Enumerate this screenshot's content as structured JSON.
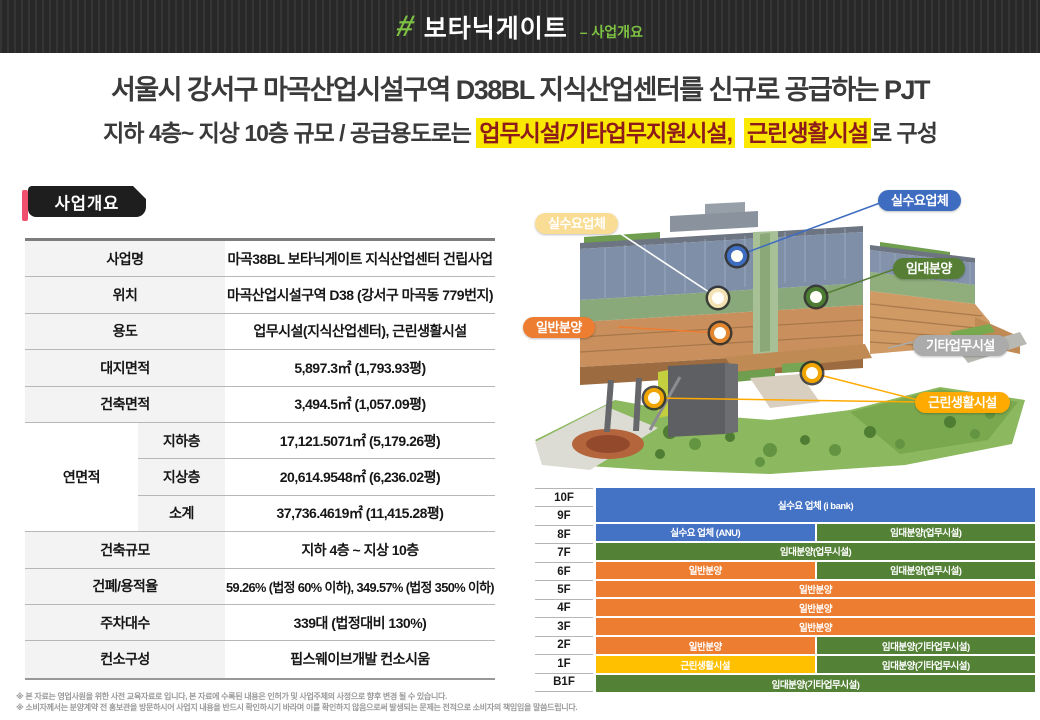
{
  "header": {
    "hash": "#",
    "brand": "보타닉게이트",
    "section": "– 사업개요"
  },
  "title": "서울시 강서구 마곡산업시설구역 D38BL 지식산업센터를 신규로 공급하는 PJT",
  "subtitle": {
    "part1": "지하 4층~ 지상 10층 규모 / 공급용도로는 ",
    "highlight1": "업무시설/기타업무지원시설,",
    "highlight2": "근린생활시설",
    "part2": "로 구성"
  },
  "overview": {
    "tab_label": "사업개요",
    "rows_top": [
      {
        "label": "사업명",
        "value": "마곡38BL 보타닉게이트 지식산업센터 건립사업"
      },
      {
        "label": "위치",
        "value": "마곡산업시설구역 D38 (강서구 마곡동 779번지)"
      },
      {
        "label": "용도",
        "value": "업무시설(지식산업센터), 근린생활시설"
      },
      {
        "label": "대지면적",
        "value": "5,897.3㎡ (1,793.93평)"
      },
      {
        "label": "건축면적",
        "value": "3,494.5㎡ (1,057.09평)"
      }
    ],
    "area": {
      "label": "연면적",
      "sub_rows": [
        {
          "label": "지하층",
          "value": "17,121.5071㎡ (5,179.26평)"
        },
        {
          "label": "지상층",
          "value": "20,614.9548㎡ (6,236.02평)"
        },
        {
          "label": "소계",
          "value": "37,736.4619㎡ (11,415.28평)"
        }
      ]
    },
    "rows_bottom": [
      {
        "label": "건축규모",
        "value": "지하 4층 ~ 지상 10층"
      },
      {
        "label": "건폐/용적율",
        "value": "59.26% (법정 60% 이하), 349.57% (법정 350% 이하)"
      },
      {
        "label": "주차대수",
        "value": "339대 (법정대비 130%)"
      },
      {
        "label": "컨소구성",
        "value": "핍스웨이브개발 컨소시움"
      }
    ]
  },
  "building": {
    "callouts": [
      {
        "id": "demand-top",
        "label": "실수요업체",
        "color": "#3e6cc0"
      },
      {
        "id": "demand-left",
        "label": "실수요업체",
        "color": "#f9dd94"
      },
      {
        "id": "lease",
        "label": "임대분양",
        "color": "#567f35"
      },
      {
        "id": "general",
        "label": "일반분양",
        "color": "#ed7d31"
      },
      {
        "id": "other-biz",
        "label": "기타업무시설",
        "color": "#ababab"
      },
      {
        "id": "neighborhood",
        "label": "근린생활시설",
        "color": "#ffaa00"
      }
    ]
  },
  "floor_chart": {
    "type": "table",
    "floor_labels": [
      "10F",
      "9F",
      "8F",
      "7F",
      "6F",
      "5F",
      "4F",
      "3F",
      "2F",
      "1F",
      "B1F"
    ],
    "legend_colors": {
      "demand": "#4472c4",
      "lease": "#538135",
      "general": "#ed7d31",
      "neighborhood": "#ffc000"
    },
    "rows": [
      {
        "floors": "10F-9F",
        "segments": [
          {
            "type": "demand",
            "label": "실수요 업체 (i bank)",
            "width": 100
          }
        ]
      },
      {
        "floors": "8F",
        "segments": [
          {
            "type": "demand",
            "label": "실수요 업체 (ANU)",
            "width": 50
          },
          {
            "type": "lease",
            "label": "임대분양(업무시설)",
            "width": 50
          }
        ]
      },
      {
        "floors": "7F",
        "segments": [
          {
            "type": "lease",
            "label": "임대분양(업무시설)",
            "width": 100
          }
        ]
      },
      {
        "floors": "6F",
        "segments": [
          {
            "type": "general",
            "label": "일반분양",
            "width": 50
          },
          {
            "type": "lease",
            "label": "임대분양(업무시설)",
            "width": 50
          }
        ]
      },
      {
        "floors": "5F",
        "segments": [
          {
            "type": "general",
            "label": "일반분양",
            "width": 100
          }
        ]
      },
      {
        "floors": "4F",
        "segments": [
          {
            "type": "general",
            "label": "일반분양",
            "width": 100
          }
        ]
      },
      {
        "floors": "3F",
        "segments": [
          {
            "type": "general",
            "label": "일반분양",
            "width": 100
          }
        ]
      },
      {
        "floors": "2F",
        "segments": [
          {
            "type": "general",
            "label": "일반분양",
            "width": 50
          },
          {
            "type": "lease",
            "label": "임대분양(기타업무시설)",
            "width": 50
          }
        ]
      },
      {
        "floors": "1F",
        "segments": [
          {
            "type": "neighborhood",
            "label": "근린생활시설",
            "width": 50
          },
          {
            "type": "lease",
            "label": "임대분양(기타업무시설)",
            "width": 50
          }
        ]
      },
      {
        "floors": "B1F",
        "segments": [
          {
            "type": "lease",
            "label": "임대분양(기타업무시설)",
            "width": 100
          }
        ]
      }
    ]
  },
  "footnotes": [
    "※ 본 자료는 영업사원을 위한 사전 교육자료로 입니다, 본 자료에 수록된 내용은 인허가 및 사업주체의 사정으로 향후 변경 될 수 있습니다.",
    "※ 소비자께서는 분양계약 전 홍보관을 방문하시어 사업지 내용을 반드시 확인하시기 바라며 이를 확인하지 않음으로써 발생되는 문제는 전적으로 소비자의 책임임을 말씀드립니다."
  ],
  "colors": {
    "accent_green": "#7dc242",
    "header_bg": "#2a2a2a",
    "tab_accent_pink": "#f0506e",
    "highlight_yellow": "#fae800",
    "highlight_text_red": "#8e1b1b"
  }
}
